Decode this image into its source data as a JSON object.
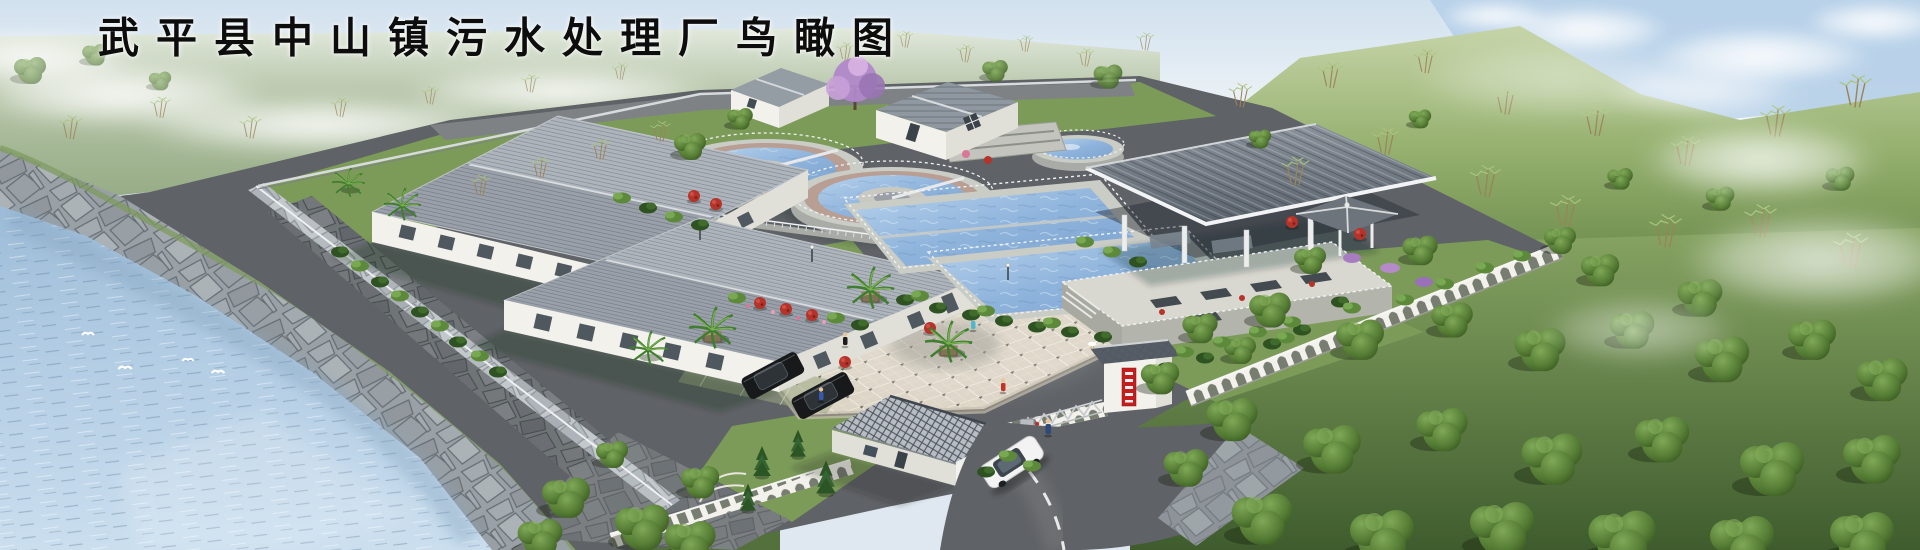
{
  "title": "武平县中山镇污水处理厂鸟瞰图",
  "scene": {
    "kind": "aerial architectural rendering",
    "subject": "sewage treatment plant beside a river",
    "elements": [
      {
        "name": "river",
        "desc": "blue water body lower-left with white egrets"
      },
      {
        "name": "stone-embankment",
        "desc": "riprap revetment along river"
      },
      {
        "name": "workshop-building-upper",
        "desc": "white workshop with gray tile hip roof"
      },
      {
        "name": "workshop-building-lower",
        "desc": "white workshop with gray tile hip roof"
      },
      {
        "name": "circular-clarifier-left",
        "desc": "round tank, blue water, pink walkway ring"
      },
      {
        "name": "circular-clarifier-right",
        "desc": "round tank with center mechanism"
      },
      {
        "name": "rect-pool-upper",
        "desc": "rectangular basin with railings"
      },
      {
        "name": "rect-pool-lower",
        "desc": "rectangular basin with railings"
      },
      {
        "name": "small-round-tank",
        "desc": "small circular tank"
      },
      {
        "name": "equipment-canopy",
        "desc": "large open steel canopy on white columns"
      },
      {
        "name": "filter-platform",
        "desc": "raised concrete platform with grates and hydrants"
      },
      {
        "name": "gazebo",
        "desc": "small gray-roof pavilion"
      },
      {
        "name": "gatehouse",
        "desc": "white guard house with lattice tile roof"
      },
      {
        "name": "gate-pillar",
        "desc": "white pillar, tiled cap, red vertical sign"
      },
      {
        "name": "accordion-gate",
        "desc": "retractable folding gate"
      },
      {
        "name": "plaza",
        "desc": "diamond-grid paved square with palms"
      },
      {
        "name": "entry-road",
        "desc": "curved asphalt road with dashed centerline"
      },
      {
        "name": "boundary-wall",
        "desc": "white wall with arched lattice openings"
      },
      {
        "name": "hillside",
        "desc": "grassy slope with bamboo clumps"
      },
      {
        "name": "forest",
        "desc": "dense green trees right and bottom-right"
      }
    ],
    "counts": {
      "flying_birds": 5,
      "circular_clarifiers": 2,
      "rectangular_pools": 2,
      "workshop_buildings": 2,
      "small_buildings": 3,
      "black_cars": 2,
      "white_cars": 1,
      "people": 5,
      "palm_trees": 6
    },
    "gate_sign": {
      "color": "#c41f1f",
      "text_legible": false
    }
  },
  "palette": {
    "sky_top": "#c9dcec",
    "sky_haze": "#eef3f6",
    "sky_blue": "#a9c8e4",
    "field_far": "#a9bb9e",
    "hill_green": "#8fab68",
    "forest_dark": "#3f5c2e",
    "grass": "#7c9b59",
    "water_light": "#c2d8ea",
    "water_deep": "#9dbcd8",
    "stone": "#9aa1a6",
    "roof_gray": "#99a0a9",
    "roof_light": "#adb4bc",
    "roof_ridge": "#d9dcdf",
    "wall_white": "#f2f1eb",
    "wall_shade": "#e0dfd8",
    "pool_water": "#8fb4dc",
    "pool_rim": "#caccc6",
    "clarifier_ring": "#b89e93",
    "plaza_tile": "#dcd4c5",
    "plaza_line": "#f1ede2",
    "plaza_accent": "#63635a",
    "asphalt": "#5f6266",
    "road_line": "#e8eaea",
    "canopy": "#6e7780",
    "lattice": "#4d545b",
    "accent_red": "#b5332a",
    "sign_red": "#c41f1f",
    "railing": "#f0f3f5",
    "planter": "#b49a76",
    "car_black": "#17191b",
    "car_white": "#f2f3f2",
    "purple_tree": "#b088c8"
  }
}
